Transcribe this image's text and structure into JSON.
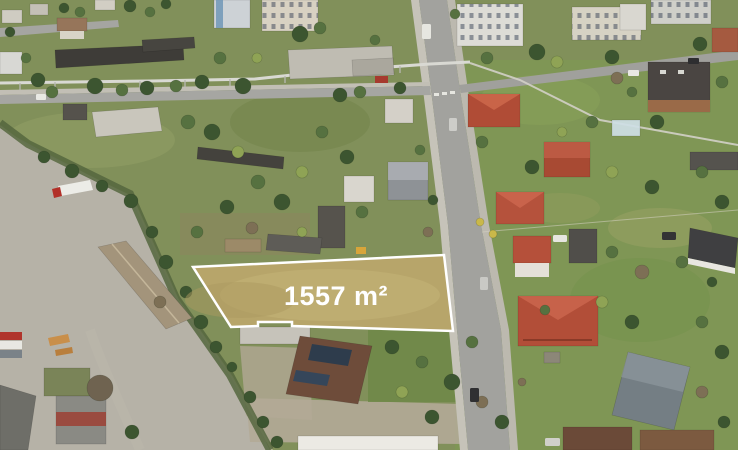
{
  "overlay": {
    "area_label": "1557 m²",
    "area_value": 1557,
    "area_unit": "m²",
    "plot_fill": "#b7a56a",
    "plot_fill_light": "#c6b578",
    "outline_color": "#ffffff",
    "label_color": "#ffffff"
  },
  "palette": {
    "grass_base": "#81905a",
    "lawn_east": "#7d9a52",
    "concrete": "#b6b2a7",
    "road": "#a2a29e",
    "sidewalk": "#c6c3b9",
    "dirt": "#b3aa97",
    "red_roof": "#b5523c",
    "dark_roof": "#413f3b",
    "white_roof": "#eceae4",
    "tree_dark": "#3c5530",
    "tree_mid": "#567140",
    "tree_light": "#8fa355",
    "tree_bare": "#7d6f55",
    "pipeline": "#d9d9d3"
  }
}
